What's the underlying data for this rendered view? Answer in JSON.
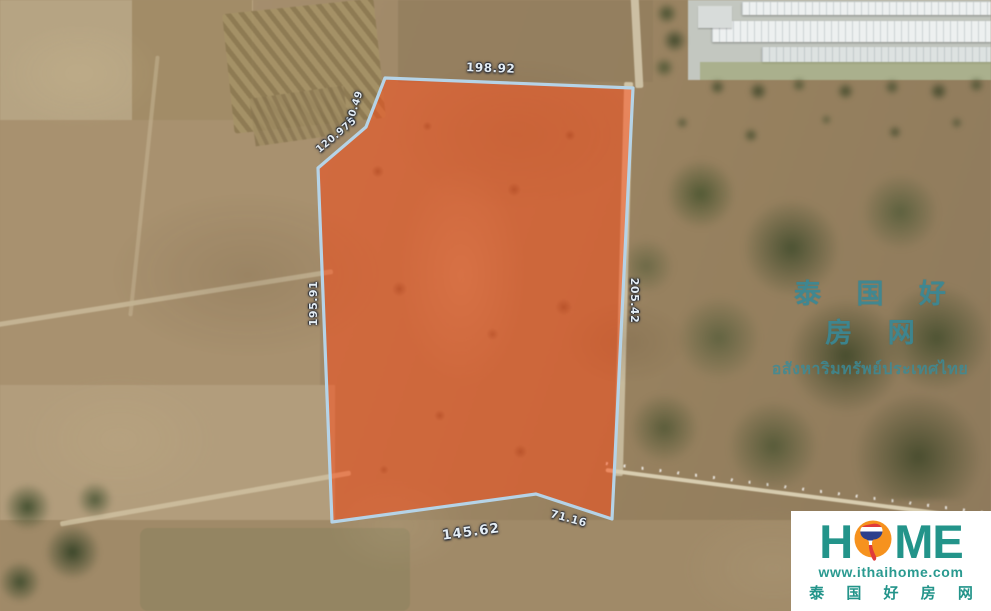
{
  "map": {
    "description": "satellite aerial view of farmland with a highlighted land plot for sale",
    "plot_fill_color": "#ff4a14",
    "plot_border_color": "#b5d3e7",
    "measurements": {
      "top_edge": "198.92",
      "nw_segment": "40.49",
      "nw_diagonal": "120.975",
      "left_edge": "195.91",
      "right_edge": "205.42",
      "bottom_edge": "145.62",
      "se_edge": "71.16"
    }
  },
  "watermark": {
    "chinese": "泰 国 好 房 网",
    "thai": "อสังหาริมทรัพย์ประเทศไทย",
    "color": "#3a8b99"
  },
  "logo": {
    "word_h": "H",
    "word_me": "ME",
    "website": "www.ithaihome.com",
    "chinese": "泰 国 好 房 网",
    "teal_color": "#23948a",
    "orange_color": "#f6921e"
  }
}
